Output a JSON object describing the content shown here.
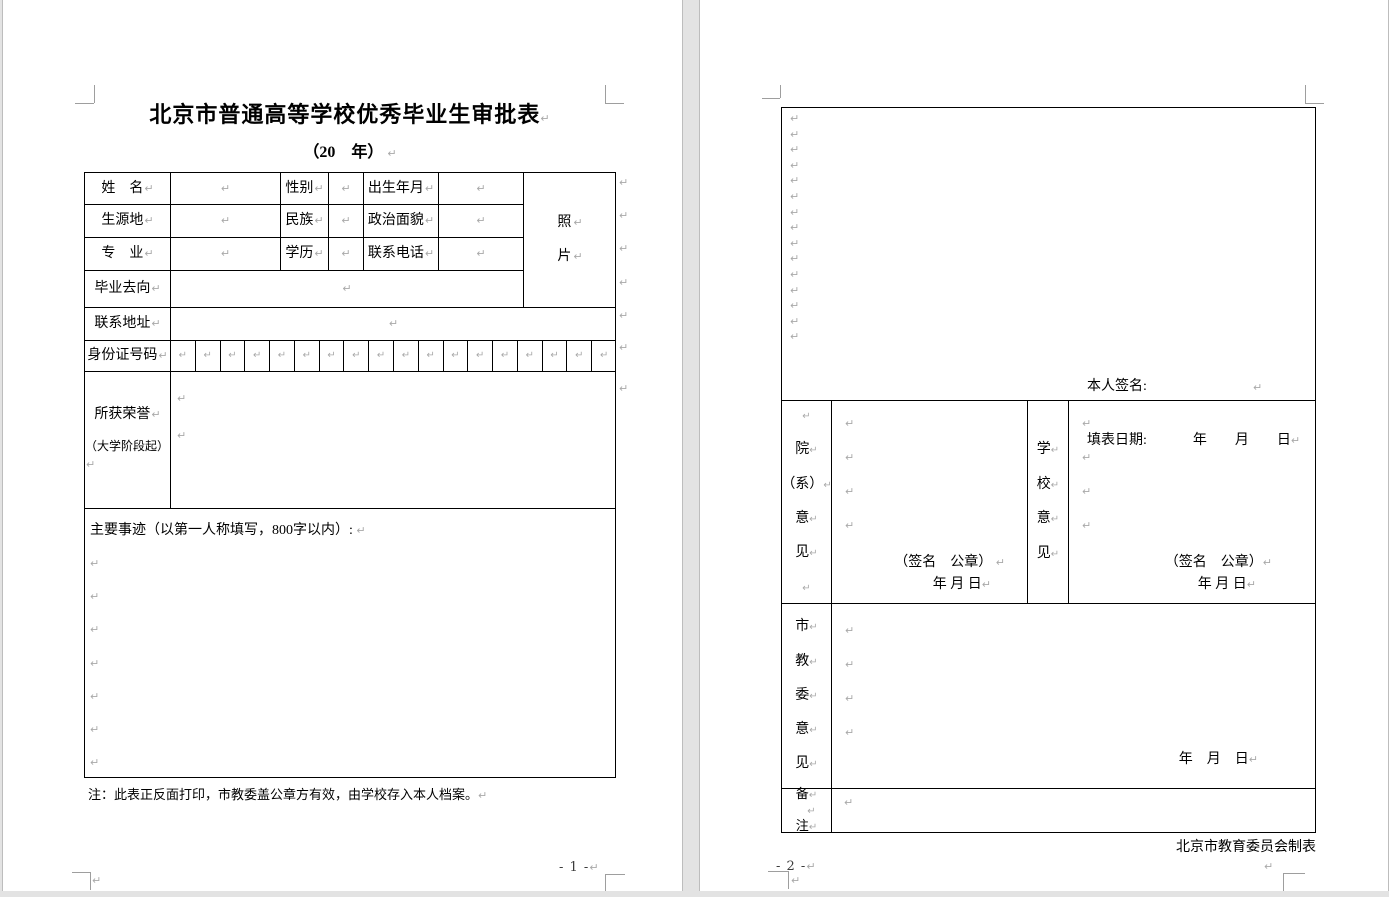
{
  "chars": {
    "pilcrow": "↵"
  },
  "page1": {
    "title": "北京市普通高等学校优秀毕业生审批表",
    "subtitle": "（20　年）",
    "labels": {
      "name": "姓　名",
      "gender": "性别",
      "birth": "出生年月",
      "origin": "生源地",
      "ethnic": "民族",
      "political": "政治面貌",
      "major": "专　业",
      "degree": "学历",
      "phone": "联系电话",
      "photo1": "照",
      "photo2": "片",
      "grad_dest": "毕业去向",
      "address": "联系地址",
      "id_no": "身份证号码",
      "honors1": "所获荣誉",
      "honors2": "（大学阶段起）",
      "deeds_heading": "主要事迹（以第一人称填写，800字以内）:"
    },
    "note": "注：此表正反面打印，市教委盖公章方有效，由学校存入本人档案。",
    "page_number": "- 1 -"
  },
  "page2": {
    "self_sign": "本人签名:",
    "fill_date": "填表日期:",
    "fill_date_ymd": "年　　月　　日",
    "dept_lines": [
      "院",
      "（系）",
      "意",
      "见"
    ],
    "school_lines": [
      "学",
      "校",
      "意",
      "见"
    ],
    "committee_lines": [
      "市",
      "教",
      "委",
      "意",
      "见"
    ],
    "remark_lines": [
      "备",
      "注"
    ],
    "sign_seal": "（签名　公章）",
    "ymd_small": "年 月 日",
    "ymd_wide": "年　月　日",
    "maker": "北京市教育委员会制表",
    "page_number": "- 2 -"
  }
}
